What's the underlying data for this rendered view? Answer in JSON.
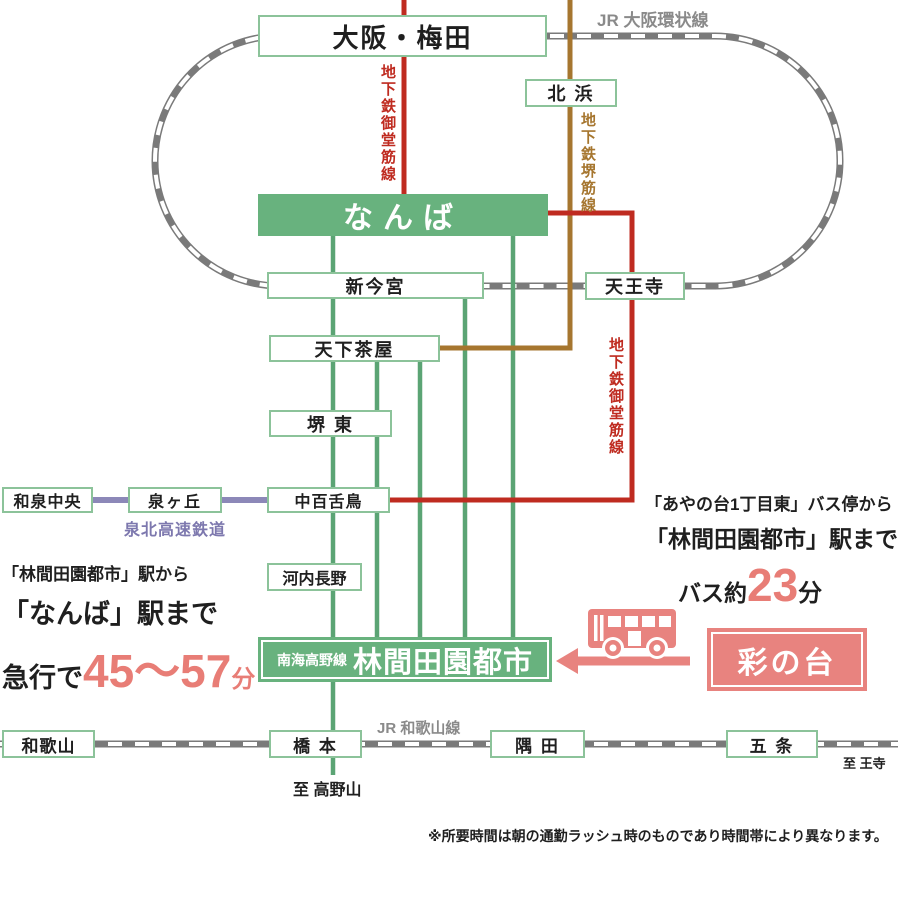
{
  "stations": {
    "osaka_umeda": "大阪・梅田",
    "kitahama": "北 浜",
    "namba": "なんば",
    "shinimamiya": "新今宮",
    "tennoji": "天王寺",
    "tengachaya": "天下茶屋",
    "sakaihigashi": "堺 東",
    "izumichuo": "和泉中央",
    "izumigaoka": "泉ヶ丘",
    "nakamozu": "中百舌鳥",
    "kawachinagano": "河内長野",
    "rinkan_prefix": "南海高野線",
    "rinkan": "林間田園都市",
    "sainodai": "彩の台",
    "wakayama": "和歌山",
    "hashimoto": "橋 本",
    "suda": "隅 田",
    "gojo": "五 条"
  },
  "line_labels": {
    "jr_loop": "JR 大阪環状線",
    "midosuji_top": "地下鉄御堂筋線",
    "sakaisuji": "地下鉄堺筋線",
    "midosuji_right": "地下鉄御堂筋線",
    "semboku": "泉北高速鉄道",
    "jr_wakayama": "JR 和歌山線",
    "to_oji": "至 王寺",
    "to_koyasan": "至 高野山"
  },
  "left_info": {
    "line1": "「林間田園都市」駅から",
    "line2": "「なんば」駅まで",
    "prefix": "急行で",
    "time": "45〜57",
    "unit": "分"
  },
  "right_info": {
    "line1": "「あやの台1丁目東」バス停から",
    "line2": "「林間田園都市」駅まで",
    "prefix": "バス約",
    "time": "23",
    "unit": "分"
  },
  "note": "※所要時間は朝の通勤ラッシュ時のものであり時間帯により異なります。",
  "colors": {
    "station_green_fill": "#68b27e",
    "station_border_green": "#8cc39a",
    "midosuji_red": "#bf2b20",
    "sakaisuji_brown": "#a6762f",
    "semboku_purple": "#8c88b8",
    "nankai_green_line": "#5ba474",
    "jr_gray": "#7a7a7a",
    "salmon_accent": "#e8837f"
  },
  "icons": {
    "bus": "bus-icon",
    "arrow": "left-arrow-icon"
  }
}
